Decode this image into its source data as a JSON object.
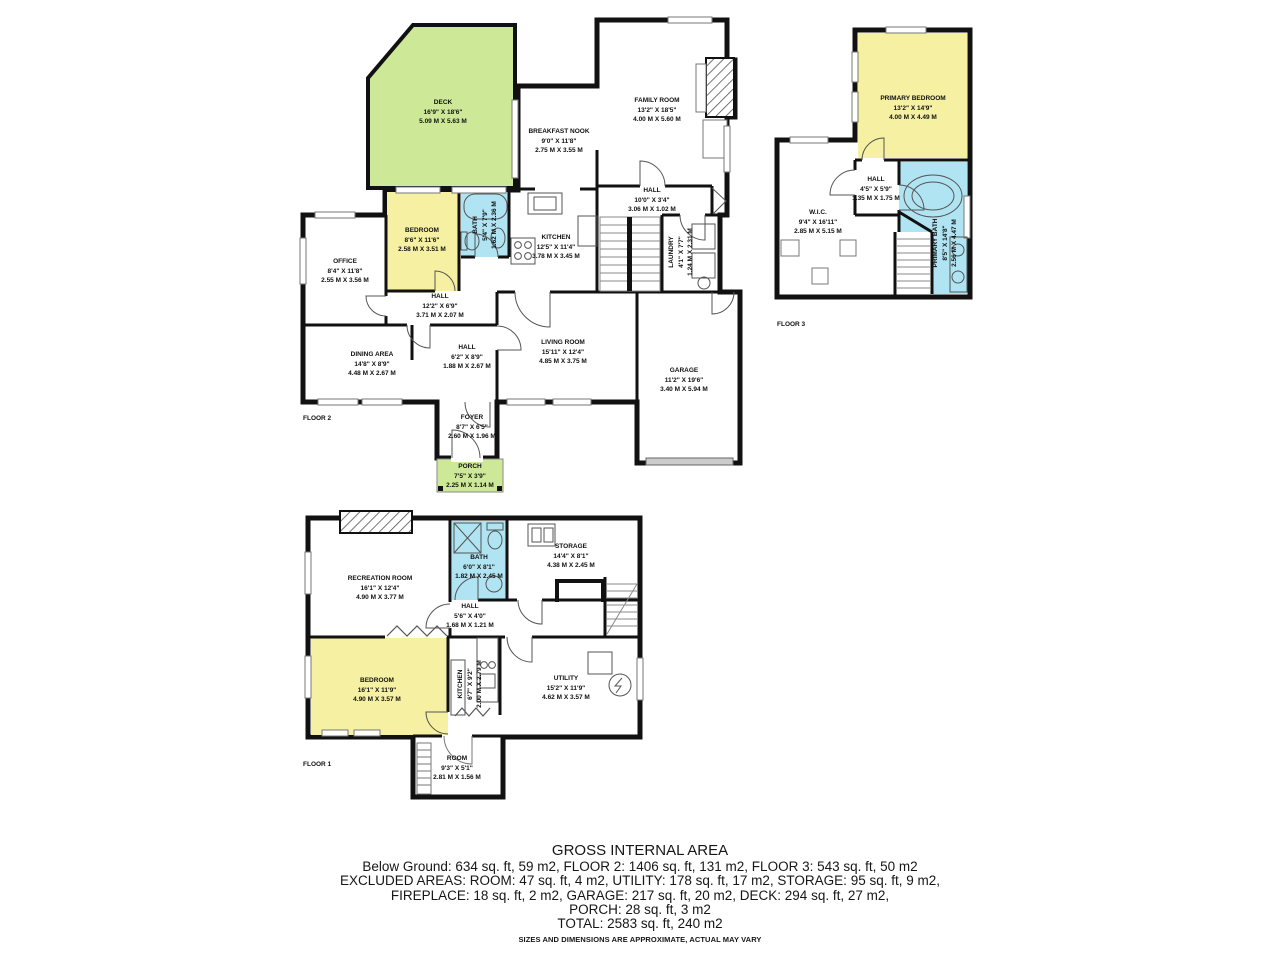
{
  "colors": {
    "deck": "#cde997",
    "bedroom": "#f6f0a2",
    "bath": "#b0e4f2",
    "wall": "#111111",
    "garage_door": "#cccccc"
  },
  "floors": {
    "floor2": {
      "label": "FLOOR 2",
      "rooms": {
        "deck": {
          "name": "DECK",
          "ft": "16'9\" X 18'6\"",
          "m": "5.09 M X 5.63 M"
        },
        "breakfast_nook": {
          "name": "BREAKFAST NOOK",
          "ft": "9'0\" X 11'8\"",
          "m": "2.75 M X 3.55 M"
        },
        "family_room": {
          "name": "FAMILY ROOM",
          "ft": "13'2\" X 18'5\"",
          "m": "4.00 M X 5.60 M"
        },
        "office": {
          "name": "OFFICE",
          "ft": "8'4\" X 11'8\"",
          "m": "2.55 M X 3.56 M"
        },
        "bedroom": {
          "name": "BEDROOM",
          "ft": "8'6\" X 11'6\"",
          "m": "2.58 M X 3.51 M"
        },
        "bath": {
          "name": "BATH",
          "ft": "5'4\" X 7'9\"",
          "m": "1.62 M X 2.36 M"
        },
        "kitchen": {
          "name": "KITCHEN",
          "ft": "12'5\" X 11'4\"",
          "m": "3.78 M X 3.45 M"
        },
        "hall_upper": {
          "name": "HALL",
          "ft": "10'0\" X 3'4\"",
          "m": "3.06 M X 1.02 M"
        },
        "laundry": {
          "name": "LAUNDRY",
          "ft": "4'1\" X 7'7\"",
          "m": "1.24 M X 2.31 M"
        },
        "hall_mid": {
          "name": "HALL",
          "ft": "12'2\" X 6'9\"",
          "m": "3.71 M X 2.07 M"
        },
        "dining": {
          "name": "DINING AREA",
          "ft": "14'8\" X 8'9\"",
          "m": "4.48 M X 2.67 M"
        },
        "hall_lower": {
          "name": "HALL",
          "ft": "6'2\" X 8'9\"",
          "m": "1.88 M X 2.67 M"
        },
        "living": {
          "name": "LIVING ROOM",
          "ft": "15'11\" X 12'4\"",
          "m": "4.85 M X 3.75 M"
        },
        "garage": {
          "name": "GARAGE",
          "ft": "11'2\" X 19'6\"",
          "m": "3.40 M X 5.94 M"
        },
        "foyer": {
          "name": "FOYER",
          "ft": "8'7\" X 6'5\"",
          "m": "2.60 M X 1.96 M"
        },
        "porch": {
          "name": "PORCH",
          "ft": "7'5\" X 3'9\"",
          "m": "2.25 M X 1.14 M"
        }
      }
    },
    "floor3": {
      "label": "FLOOR 3",
      "rooms": {
        "primary_bedroom": {
          "name": "PRIMARY BEDROOM",
          "ft": "13'2\" X 14'9\"",
          "m": "4.00 M X 4.49 M"
        },
        "hall": {
          "name": "HALL",
          "ft": "4'5\" X 5'9\"",
          "m": "1.35 M X 1.75 M"
        },
        "wic": {
          "name": "W.I.C.",
          "ft": "9'4\" X 16'11\"",
          "m": "2.85 M X 5.15 M"
        },
        "primary_bath": {
          "name": "PRIMARY BATH",
          "ft": "8'5\" X 14'8\"",
          "m": "2.56 M X 4.47 M"
        }
      }
    },
    "floor1": {
      "label": "FLOOR 1",
      "rooms": {
        "recreation": {
          "name": "RECREATION ROOM",
          "ft": "16'1\" X 12'4\"",
          "m": "4.90 M X 3.77 M"
        },
        "bath": {
          "name": "BATH",
          "ft": "6'0\" X 8'1\"",
          "m": "1.82 M X 2.45 M"
        },
        "storage": {
          "name": "STORAGE",
          "ft": "14'4\" X 8'1\"",
          "m": "4.38 M X 2.45 M"
        },
        "hall": {
          "name": "HALL",
          "ft": "5'6\" X 4'0\"",
          "m": "1.68 M X 1.21 M"
        },
        "bedroom": {
          "name": "BEDROOM",
          "ft": "16'1\" X 11'9\"",
          "m": "4.90 M X 3.57 M"
        },
        "kitchen": {
          "name": "KITCHEN",
          "ft": "6'7\" X 9'2\"",
          "m": "2.00 M X 2.79 M"
        },
        "utility": {
          "name": "UTILITY",
          "ft": "15'2\" X 11'9\"",
          "m": "4.62 M X 3.57 M"
        },
        "room": {
          "name": "ROOM",
          "ft": "9'3\" X 5'1\"",
          "m": "2.81 M X 1.56 M"
        }
      }
    }
  },
  "summary": {
    "title": "GROSS INTERNAL AREA",
    "line1": "Below Ground: 634 sq. ft, 59 m2, FLOOR 2: 1406 sq. ft, 131 m2, FLOOR 3: 543 sq. ft, 50 m2",
    "line2": "EXCLUDED AREAS: ROOM: 47 sq. ft, 4 m2, UTILITY: 178 sq. ft, 17 m2, STORAGE: 95 sq. ft, 9 m2,",
    "line3": "FIREPLACE: 18 sq. ft, 2 m2, GARAGE: 217 sq. ft, 20 m2, DECK: 294 sq. ft, 27 m2,",
    "line4": "PORCH: 28 sq. ft, 3 m2",
    "total": "TOTAL: 2583 sq. ft, 240 m2",
    "disclaimer": "SIZES AND DIMENSIONS ARE APPROXIMATE, ACTUAL MAY VARY"
  }
}
